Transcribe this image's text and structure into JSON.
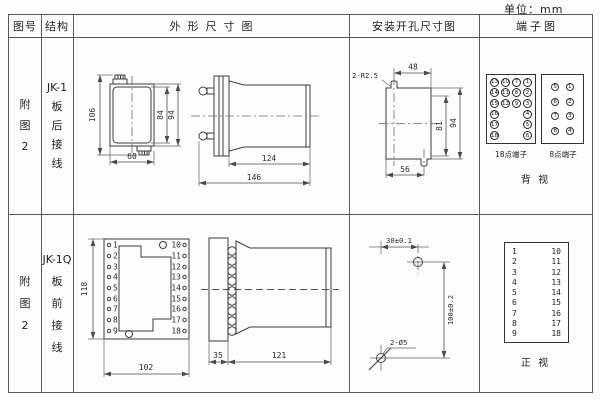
{
  "unit_label": "单位：mm",
  "header": {
    "figure": "图号",
    "structure": "结构",
    "outline": "外形尺寸图",
    "install": "安装开孔尺寸图",
    "terminal": "端子图"
  },
  "r1": {
    "figure": [
      "附",
      "图",
      "2"
    ],
    "structure": [
      "JK-1",
      "板",
      "后",
      "接",
      "线"
    ],
    "dims": {
      "total_h": "106",
      "inner_h": "84",
      "outer_h": "94",
      "width": "60",
      "body_len": "124",
      "total_len": "146"
    },
    "install": {
      "slot": "2-R2.5",
      "top_w": "48",
      "inner_h": "81",
      "outer_h": "94",
      "bottom_w": "56"
    },
    "term": {
      "t18_label": "18点端子",
      "t8_label": "8点端子",
      "view": "背 视",
      "t18": [
        [
          "13",
          "10",
          "7",
          "1"
        ],
        [
          "14",
          "11",
          "8",
          "2"
        ],
        [
          "15",
          "12",
          "9",
          "3"
        ],
        [
          "16",
          "",
          "",
          "4"
        ],
        [
          "17",
          "",
          "",
          "5"
        ],
        [
          "18",
          "",
          "",
          "6"
        ]
      ],
      "t8": [
        [
          "5",
          "1"
        ],
        [
          "6",
          "2"
        ],
        [
          "7",
          "3"
        ],
        [
          "8",
          "4"
        ]
      ]
    }
  },
  "r2": {
    "figure": [
      "附",
      "图",
      "2"
    ],
    "structure": [
      "JK-1Q",
      "板",
      "前",
      "接",
      "线"
    ],
    "dims": {
      "height": "118",
      "width": "102",
      "flange": "35",
      "body_len": "121"
    },
    "left_terms": [
      "1",
      "2",
      "3",
      "4",
      "5",
      "6",
      "7",
      "8",
      "9"
    ],
    "right_terms": [
      "10",
      "11",
      "12",
      "13",
      "14",
      "15",
      "16",
      "17",
      "18"
    ],
    "install": {
      "hole": "2-Ø5",
      "h": "30±0.1",
      "v": "100±0.2"
    },
    "term": {
      "view": "正 视",
      "pairs": [
        [
          "1",
          "10"
        ],
        [
          "2",
          "11"
        ],
        [
          "3",
          "12"
        ],
        [
          "4",
          "13"
        ],
        [
          "5",
          "14"
        ],
        [
          "6",
          "15"
        ],
        [
          "7",
          "16"
        ],
        [
          "8",
          "17"
        ],
        [
          "9",
          "18"
        ]
      ]
    }
  }
}
